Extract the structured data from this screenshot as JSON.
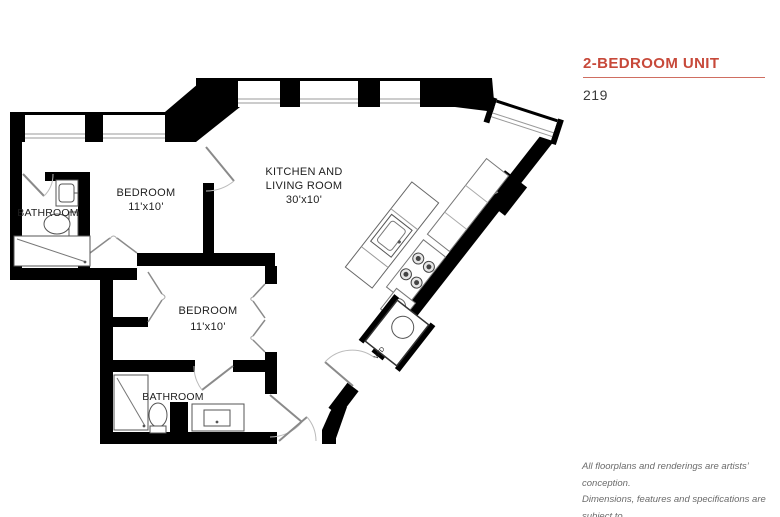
{
  "header": {
    "title": "2-BEDROOM UNIT",
    "unit_number": "219"
  },
  "floorplan": {
    "labels": {
      "bathroom1": "BATHROOM",
      "bedroom1_name": "BEDROOM",
      "bedroom1_dim": "11'x10'",
      "kitchen_line1": "KITCHEN AND",
      "kitchen_line2": "LIVING ROOM",
      "kitchen_dim": "30'x10'",
      "bedroom2_name": "BEDROOM",
      "bedroom2_dim": "11'x10'",
      "bathroom2": "BATHROOM",
      "laundry": "W/D"
    }
  },
  "disclaimer": {
    "line1": "All floorplans and renderings are artists’ conception.",
    "line2": "Dimensions, features and specifications are subject to",
    "line3": "change at the discretion of the builder."
  },
  "colors": {
    "accent": "#C7493A",
    "wall": "#000000",
    "muted_text": "#6B6B6B"
  }
}
